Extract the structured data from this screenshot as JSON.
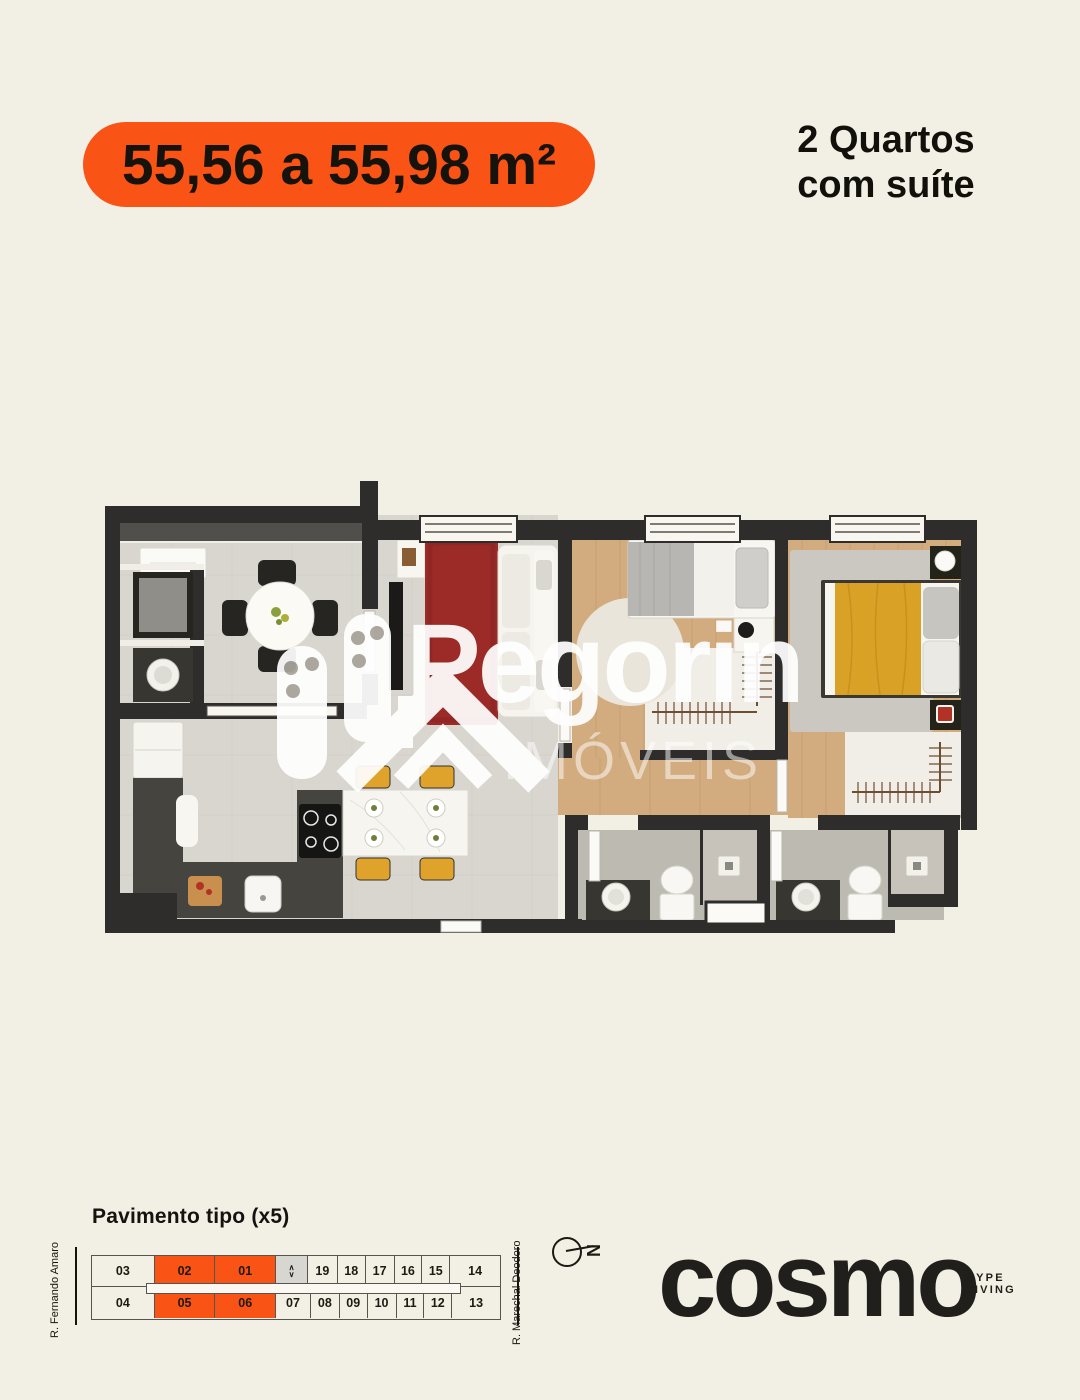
{
  "page": {
    "background": "#f2efe4"
  },
  "header": {
    "area_badge": "55,56 a 55,98 m²",
    "unit_type_line1": "2 Quartos",
    "unit_type_line2": "com suíte",
    "accent_color": "#f95315"
  },
  "watermark": {
    "brand": "Pegorin",
    "subtitle": "IMÓVEIS"
  },
  "floorplan_colors": {
    "wall": "#2e2d2b",
    "tile_floor": "#d8d6cf",
    "wood_floor": "#d2ab7e",
    "bath_floor": "#bdbab2",
    "rug_red": "#9c2b28",
    "rug_gray": "#cbc8c1",
    "duvet_yellow": "#d9a226",
    "chair_yellow": "#dfa32b",
    "counter": "#45443f"
  },
  "footer": {
    "floor_plan_label": "Pavimento tipo (x5)",
    "street_left": "R. Fernando Amaro",
    "street_right": "R. Marechal Deodoro",
    "compass_letter": "N",
    "elevator_up": "∧",
    "elevator_down": "∨",
    "units_top": [
      "03",
      "02",
      "01",
      "19",
      "18",
      "17",
      "16",
      "15",
      "14"
    ],
    "units_bottom": [
      "04",
      "05",
      "06",
      "07",
      "08",
      "09",
      "10",
      "11",
      "12",
      "13"
    ],
    "highlighted_units": [
      "01",
      "02",
      "05",
      "06"
    ],
    "brand_name": "cosmo",
    "brand_tag_line1": "HYPE",
    "brand_tag_line2": "LIVING"
  }
}
